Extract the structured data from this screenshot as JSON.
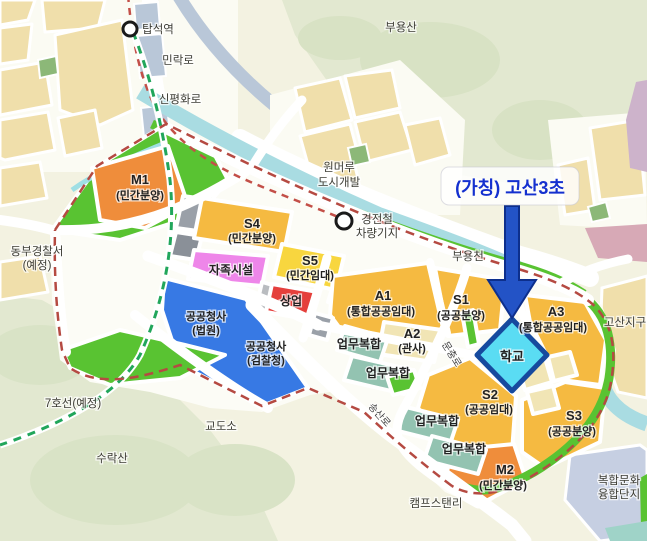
{
  "map_title": "(가칭) 고산3초 위치도",
  "callout": {
    "text": "(가칭) 고산3초"
  },
  "stations": {
    "tapseok": "탑석역",
    "depot_line1": "경전철",
    "depot_line2": "차량기지"
  },
  "roads": {
    "minrak": "민락로",
    "sinpyeonghwa": "신평화로",
    "munchung": "문충로",
    "songsan": "송산로"
  },
  "places": {
    "buyongsan": "부용산",
    "wonmeoru_line1": "원머루",
    "wonmeoru_line2": "도시개발",
    "buyongcheon": "부용천",
    "police_line1": "동부경찰서",
    "police_line2": "(예정)",
    "line7": "7호선(예정)",
    "prison": "교도소",
    "suraksan": "수락산",
    "camp_stanley": "캠프스탠리",
    "gosan_district": "고산지구",
    "culture_line1": "복합문화",
    "culture_line2": "융합단지"
  },
  "parcels": {
    "m1": {
      "code": "M1",
      "type": "(민간분양)"
    },
    "s4": {
      "code": "S4",
      "type": "(민간분양)"
    },
    "s5": {
      "code": "S5",
      "type": "(민간임대)"
    },
    "jajok": "자족시설",
    "commercial": "상업",
    "gov1": {
      "line1": "공공청사",
      "line2": "(법원)"
    },
    "gov2": {
      "line1": "공공청사",
      "line2": "(검찰청)"
    },
    "a1": {
      "code": "A1",
      "type": "(통합공공임대)"
    },
    "s1": {
      "code": "S1",
      "type": "(공공분양)"
    },
    "a2": {
      "code": "A2",
      "type": "(관사)"
    },
    "a3": {
      "code": "A3",
      "type": "(통합공공임대)"
    },
    "school": "학교",
    "s2": {
      "code": "S2",
      "type": "(공공임대)"
    },
    "s3": {
      "code": "S3",
      "type": "(공공분양)"
    },
    "m2": {
      "code": "M2",
      "type": "(민간분양)"
    },
    "biz": "업무복합"
  },
  "colors": {
    "amber": "#f5ba41",
    "orange": "#ef8d3b",
    "yellow": "#f8d63f",
    "violet": "#ee86e9",
    "red": "#e5403c",
    "blue": "#3779e4",
    "teal": "#93c3b1",
    "cream": "#f1e5b5",
    "school_fill": "#5adcf3",
    "school_border": "#164a9e",
    "green": "#59c332",
    "river": "#a9dce2",
    "lavender": "#c6cfe2",
    "pink": "#d7a9b6",
    "mauve": "#cdb3cb",
    "tan": "#f0dfab",
    "gray": "#9aa0a8",
    "boundary": "#b54a42",
    "line7_green": "#21a65b",
    "rail_red": "#c34f48",
    "callout_text": "#1430cf",
    "arrow": "#2353c6"
  }
}
